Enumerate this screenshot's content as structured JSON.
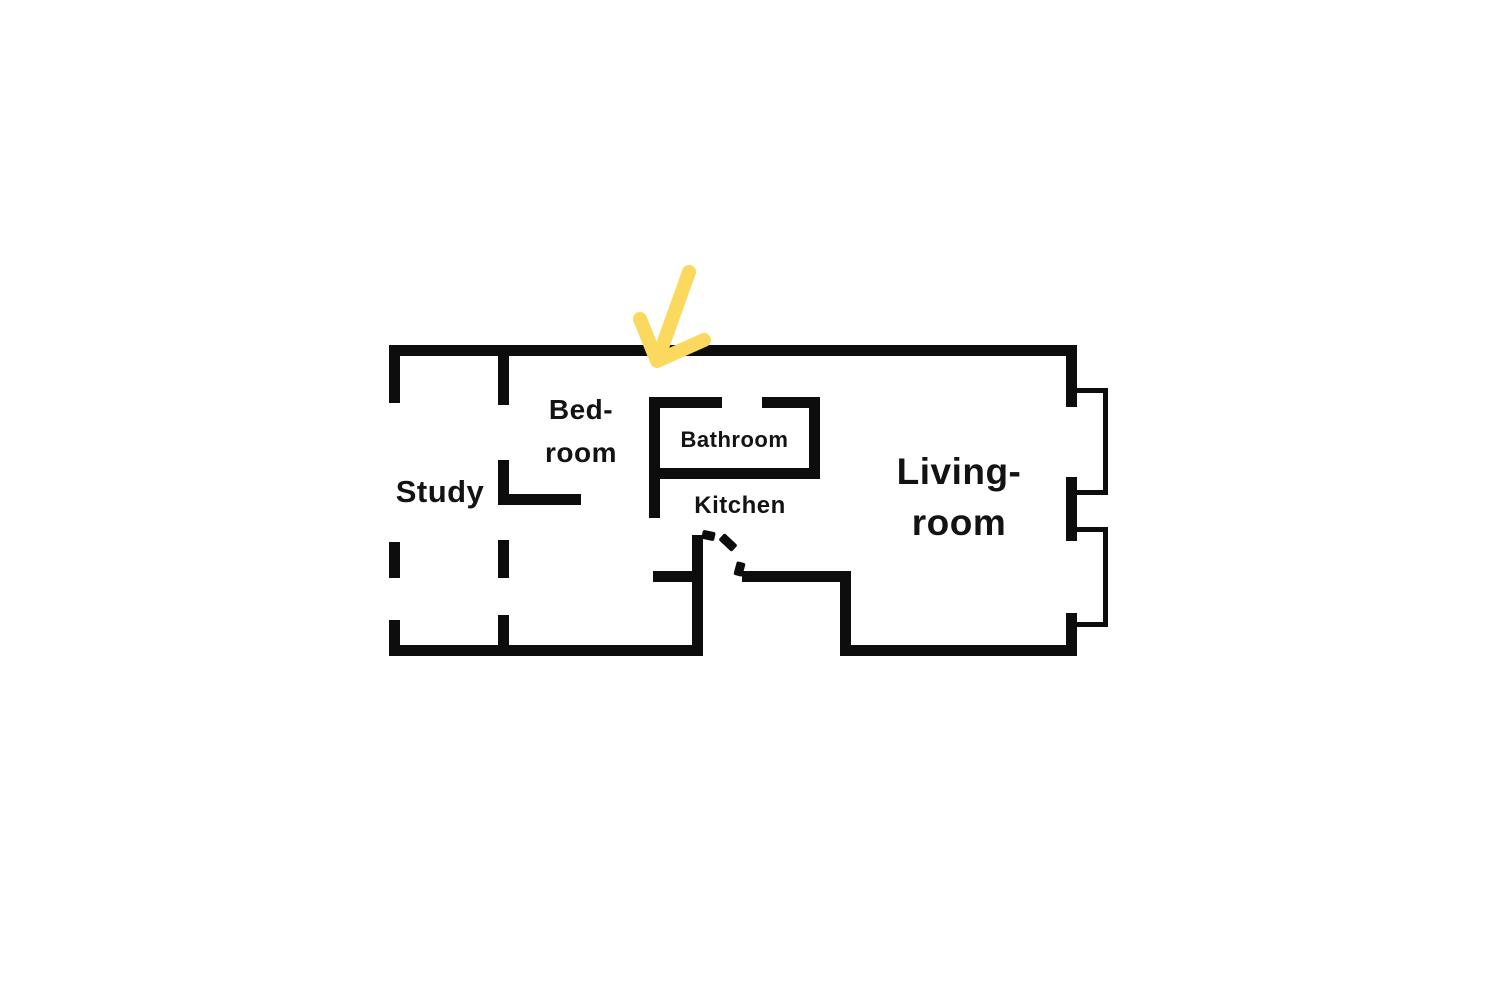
{
  "colors": {
    "background": "#ffffff",
    "wall": "#0d0d0d",
    "text": "#131313",
    "arrow": "#fbd95f"
  },
  "rooms": {
    "study": {
      "label": "Study"
    },
    "bedroom": {
      "line1": "Bed-",
      "line2": "room"
    },
    "bathroom": {
      "label": "Bathroom"
    },
    "kitchen": {
      "label": "Kitchen"
    },
    "living": {
      "line1": "Living-",
      "line2": "room"
    }
  },
  "icons": {
    "entrance_arrow": "hand-drawn-arrow-pointing-down-left-at-top-wall"
  }
}
